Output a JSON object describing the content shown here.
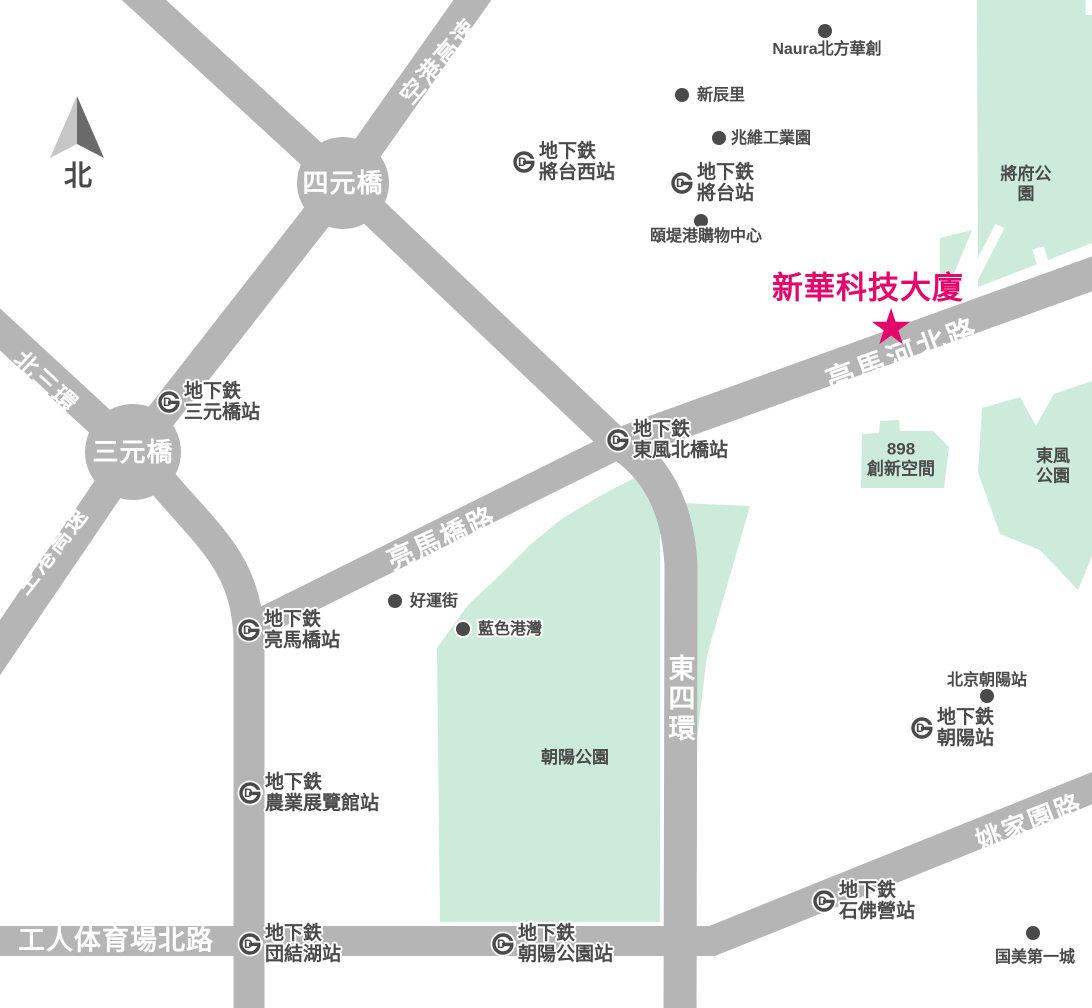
{
  "colors": {
    "road": "#b5b5b5",
    "park": "#cdebdb",
    "ink": "#4a4a4a",
    "white": "#ffffff",
    "pink": "#E3086B",
    "arrow_light": "#c6c6c6",
    "arrow_dark": "#6a6a6a"
  },
  "north": {
    "label": "北"
  },
  "star": {
    "glyph": "★",
    "label": "新華科技大廈"
  },
  "roads": [
    {
      "name": "airport-expressway",
      "path": "M 488 -22 L 343 183 L 133 452 L -20 677",
      "w": 31
    },
    {
      "name": "jingmi-diagonal",
      "path": "M 120 -22 L 343 183 L 620 446",
      "w": 30
    },
    {
      "name": "north-3rd-ring",
      "path": "M -20 311 L 133 452",
      "w": 31
    },
    {
      "name": "west-vertical-road",
      "path": "M 152 470 C 205 535 247 560 249 640 L 249 1030",
      "w": 31
    },
    {
      "name": "liangmaqiao-road",
      "path": "M 243 631 L 618 445",
      "w": 28
    },
    {
      "name": "liangmahe-north-road",
      "path": "M 612 447 L 1100 271",
      "w": 33
    },
    {
      "name": "east-4th-ring",
      "path": "M 620 444 C 658 468 678 510 681 565 L 680 1030",
      "w": 33
    },
    {
      "name": "gongti-north-yaojiayuan",
      "path": "M -10 941 L 712 941 L 1100 785",
      "w": 30
    }
  ],
  "junctions": [
    {
      "label": "四元橋",
      "x": 343,
      "y": 183,
      "r": 46
    },
    {
      "label": "三元橋",
      "x": 133,
      "y": 452,
      "r": 48
    }
  ],
  "road_labels": [
    {
      "text": "空港高速",
      "x": 440,
      "y": 62,
      "rot": -49,
      "size": 24,
      "ls": 2
    },
    {
      "text": "空港高速",
      "x": 52,
      "y": 551,
      "rot": -52,
      "size": 24,
      "ls": 2
    },
    {
      "text": "北三環",
      "x": 45,
      "y": 383,
      "rot": 43,
      "size": 24,
      "ls": 2
    },
    {
      "text": "亮馬河北路",
      "x": 903,
      "y": 356,
      "rot": -20,
      "size": 29,
      "ls": 3
    },
    {
      "text": "亮馬橋路",
      "x": 442,
      "y": 539,
      "rot": -24,
      "size": 27,
      "ls": 2
    },
    {
      "text": "姚家園路",
      "x": 1029,
      "y": 822,
      "rot": -21,
      "size": 26,
      "ls": 2
    },
    {
      "text": "工人体育場北路",
      "x": 18,
      "y": 941,
      "rot": 0,
      "size": 27,
      "ls": 1,
      "anchor": "left"
    },
    {
      "text": "東四環",
      "x": 679,
      "y": 699,
      "rot": 0,
      "size": 27,
      "ls": 3,
      "vertical": true
    }
  ],
  "parks": [
    {
      "name": "jiangfu-park",
      "points": "977,0 1086,0 1086,15 1092,15 1092,243 978,287",
      "label": "將府公園",
      "lx": 1026,
      "ly": 184
    },
    {
      "name": "jiangfu-park-west-wedge",
      "points": "940,238 972,230 951,281 940,285"
    },
    {
      "name": "dongfeng-park",
      "points": "982,408 1020,397 1036,426 1054,394 1092,381 1092,556 1078,590 1040,550 1000,534 978,472",
      "label": "東風公園",
      "lx": 1053,
      "ly": 466
    },
    {
      "name": "898-innovation-space",
      "points": "862,434 879,433 880,421 899,420 900,431 933,431 949,447 944,488 861,488",
      "label": "898\n創新空間",
      "lx": 901,
      "ly": 459
    },
    {
      "name": "chaoyang-park",
      "points": "636,477 660,497 660,922 440,922 437,648 468,605 497,578 530,545 560,520 600,496",
      "label": "朝陽公園",
      "lx": 575,
      "ly": 758
    },
    {
      "name": "east-ring-strip",
      "points": "680,503 750,506 707,655 693,772 681,772"
    }
  ],
  "park_cuts": [
    {
      "path": "M 1000 226 L 958 308",
      "w": 10
    },
    {
      "path": "M 1038 248 L 1058 312",
      "w": 12
    },
    {
      "path": "M 1089 -2 L 1089 14",
      "w": 7
    }
  ],
  "station_prefix": "地下鉄",
  "stations": [
    {
      "name": "將台西站",
      "x": 524,
      "y": 164
    },
    {
      "name": "將台站",
      "x": 682,
      "y": 185
    },
    {
      "name": "三元橋站",
      "x": 169,
      "y": 404
    },
    {
      "name": "東風北橋站",
      "x": 618,
      "y": 442
    },
    {
      "name": "亮馬橋站",
      "x": 249,
      "y": 632
    },
    {
      "name": "農業展覽館站",
      "x": 250,
      "y": 795
    },
    {
      "name": "団結湖站",
      "x": 250,
      "y": 946
    },
    {
      "name": "朝陽公園站",
      "x": 503,
      "y": 946
    },
    {
      "name": "朝陽站",
      "x": 922,
      "y": 730
    },
    {
      "name": "石佛營站",
      "x": 824,
      "y": 903
    }
  ],
  "pois": [
    {
      "name": "Naura北方華創",
      "x": 825,
      "y": 31,
      "lx": 827,
      "ly": 50,
      "align": "center"
    },
    {
      "name": "新辰里",
      "x": 682,
      "y": 95,
      "lx": 697,
      "ly": 96,
      "align": "left"
    },
    {
      "name": "兆維工業園",
      "x": 719,
      "y": 138,
      "lx": 731,
      "ly": 139,
      "align": "left"
    },
    {
      "name": "頤堤港購物中心",
      "x": 701,
      "y": 221,
      "lx": 706,
      "ly": 237,
      "align": "center"
    },
    {
      "name": "好運街",
      "x": 395,
      "y": 601,
      "lx": 410,
      "ly": 602,
      "align": "left"
    },
    {
      "name": "藍色港灣",
      "x": 463,
      "y": 629,
      "lx": 478,
      "ly": 630,
      "align": "left"
    },
    {
      "name": "北京朝陽站",
      "x": 987,
      "y": 696,
      "lx": 987,
      "ly": 681,
      "align": "center"
    },
    {
      "name": "国美第一城",
      "x": 1033,
      "y": 933,
      "lx": 1035,
      "ly": 958,
      "align": "center"
    }
  ]
}
